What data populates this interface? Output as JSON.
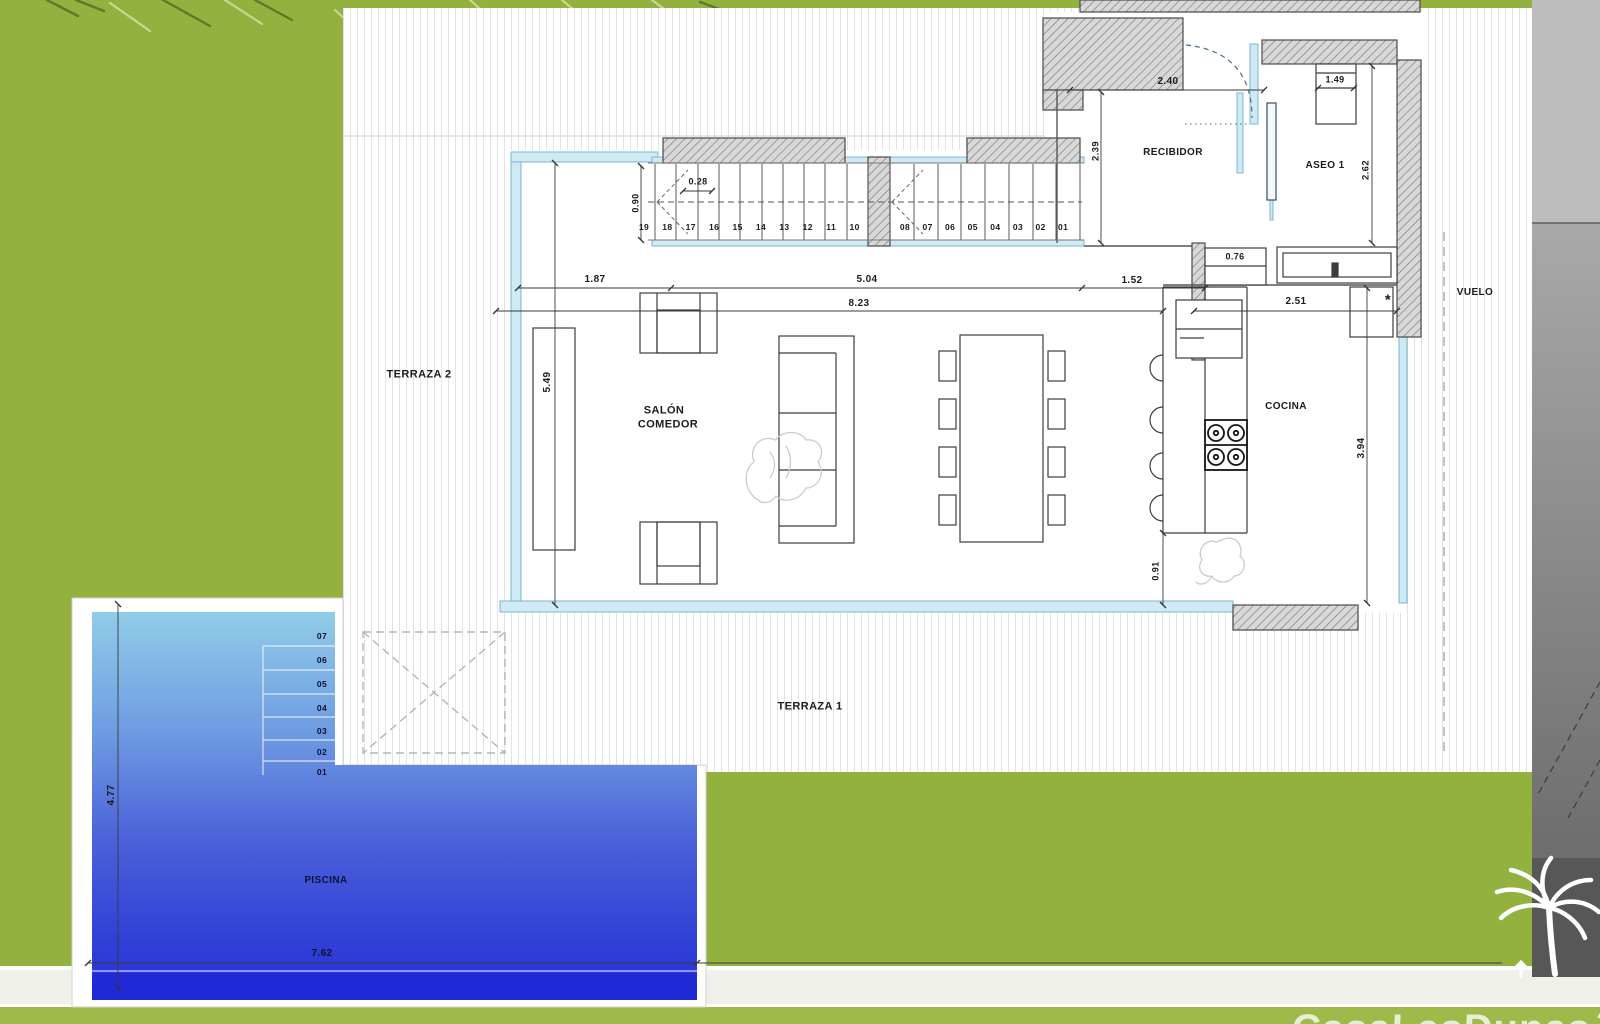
{
  "labels": [
    {
      "name": "room-label-terraza-2",
      "text": "TERRAZA 2",
      "x": 419,
      "y": 375,
      "size": 11
    },
    {
      "name": "room-label-terraza-1",
      "text": "TERRAZA 1",
      "x": 810,
      "y": 707,
      "size": 11
    },
    {
      "name": "room-label-salon-line1",
      "text": "SALÓN",
      "x": 664,
      "y": 411,
      "size": 11
    },
    {
      "name": "room-label-salon-line2",
      "text": "COMEDOR",
      "x": 668,
      "y": 425,
      "size": 11
    },
    {
      "name": "room-label-recibidor",
      "text": "RECIBIDOR",
      "x": 1173,
      "y": 153,
      "size": 10
    },
    {
      "name": "room-label-aseo-1",
      "text": "ASEO 1",
      "x": 1325,
      "y": 166,
      "size": 10
    },
    {
      "name": "room-label-cocina",
      "text": "COCINA",
      "x": 1286,
      "y": 407,
      "size": 10
    },
    {
      "name": "zone-label-vuelo",
      "text": "VUELO",
      "x": 1475,
      "y": 293,
      "size": 10
    },
    {
      "name": "room-label-piscina",
      "text": "PISCINA",
      "x": 326,
      "y": 881,
      "size": 10,
      "color": "#10123a"
    },
    {
      "name": "dim-2-40",
      "text": "2.40",
      "x": 1168,
      "y": 82,
      "size": 10
    },
    {
      "name": "dim-1-49",
      "text": "1.49",
      "x": 1335,
      "y": 80,
      "size": 9
    },
    {
      "name": "dim-2-39",
      "text": "2.39",
      "x": 1096,
      "y": 151,
      "rot": 1,
      "size": 9.5
    },
    {
      "name": "dim-2-62",
      "text": "2.62",
      "x": 1366,
      "y": 170,
      "rot": 1,
      "size": 9.5
    },
    {
      "name": "dim-0-28",
      "text": "0.28",
      "x": 698,
      "y": 182,
      "size": 9
    },
    {
      "name": "dim-0-90",
      "text": "0.90",
      "x": 636,
      "y": 203,
      "rot": 1,
      "size": 9
    },
    {
      "name": "dim-1-87",
      "text": "1.87",
      "x": 595,
      "y": 280,
      "size": 10
    },
    {
      "name": "dim-5-04",
      "text": "5.04",
      "x": 867,
      "y": 280,
      "size": 10
    },
    {
      "name": "dim-8-23",
      "text": "8.23",
      "x": 859,
      "y": 304,
      "size": 10
    },
    {
      "name": "dim-1-52",
      "text": "1.52",
      "x": 1132,
      "y": 281,
      "size": 10
    },
    {
      "name": "dim-0-76",
      "text": "0.76",
      "x": 1235,
      "y": 257,
      "size": 9
    },
    {
      "name": "dim-2-51",
      "text": "2.51",
      "x": 1296,
      "y": 302,
      "size": 10
    },
    {
      "name": "dim-5-49",
      "text": "5.49",
      "x": 548,
      "y": 382,
      "rot": 1,
      "size": 10
    },
    {
      "name": "dim-3-94",
      "text": "3.94",
      "x": 1362,
      "y": 448,
      "rot": 1,
      "size": 10
    },
    {
      "name": "dim-0-91",
      "text": "0.91",
      "x": 1156,
      "y": 571,
      "rot": 1,
      "size": 9
    },
    {
      "name": "dim-4-77",
      "text": "4.77",
      "x": 112,
      "y": 795,
      "rot": 1,
      "size": 10
    },
    {
      "name": "dim-7-62",
      "text": "7.62",
      "x": 322,
      "y": 954,
      "size": 10,
      "color": "#101226"
    },
    {
      "name": "note-asterisk",
      "text": "*",
      "x": 1388,
      "y": 300,
      "size": 15
    }
  ],
  "stairs": {
    "left": [
      "19",
      "18",
      "17",
      "16",
      "15",
      "14",
      "13",
      "12",
      "11",
      "10"
    ],
    "right": [
      "08",
      "07",
      "06",
      "05",
      "04",
      "03",
      "02",
      "01"
    ]
  },
  "pool": {
    "steps": [
      "07",
      "06",
      "05",
      "04",
      "03",
      "02",
      "01"
    ]
  },
  "watermark": {
    "text": "CasaLasDunas",
    "mark": "2"
  },
  "colors": {
    "grass": "#92b13e",
    "terrace_stripe": "#e3e3e3",
    "glass": "#cfeaf4",
    "wall_fill": "#d8d8d8",
    "pool_top": "#91cce8",
    "pool_deep": "#2a30d8",
    "footer_green": "#9fba4a",
    "panel_gray": "#8a8a8a",
    "ink": "#1b1b1b"
  }
}
